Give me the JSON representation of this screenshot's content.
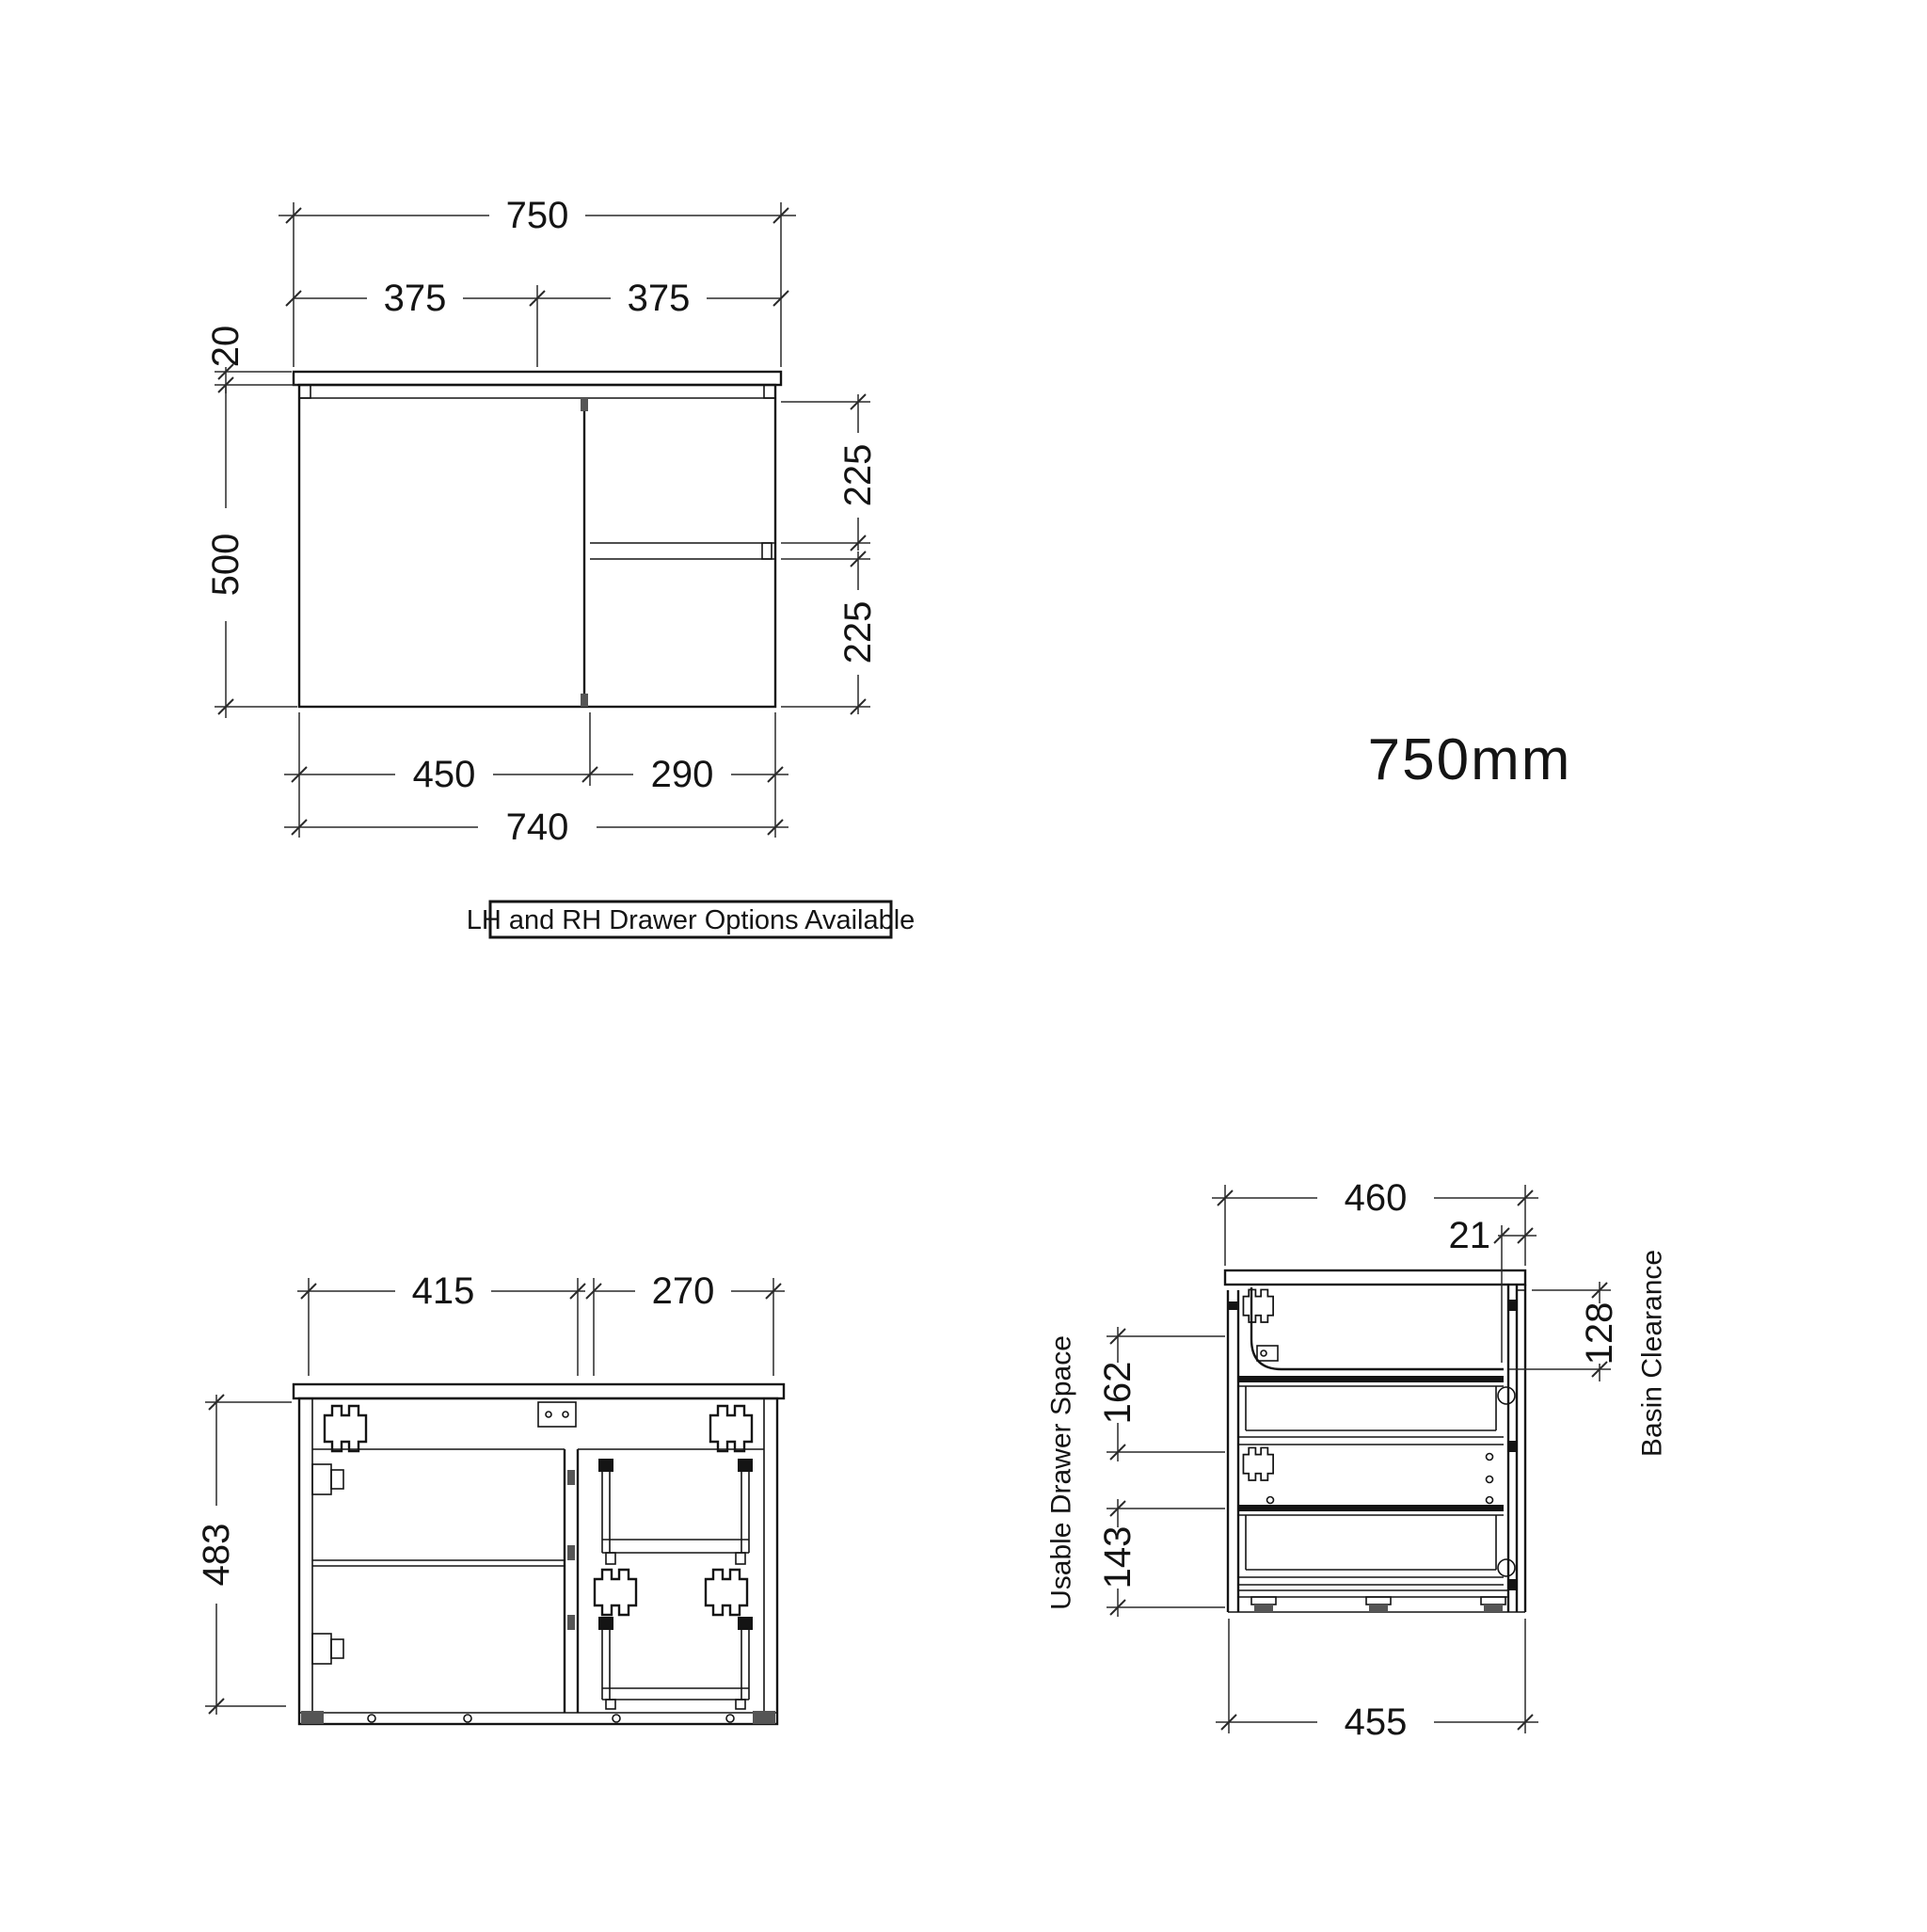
{
  "size_label": "750mm",
  "callout": {
    "text": "LH and RH Drawer Options Available"
  },
  "front_view": {
    "dims": {
      "total_width": "750",
      "half_left": "375",
      "half_right": "375",
      "top_thickness": "20",
      "body_height": "500",
      "drawer_upper_height": "225",
      "drawer_lower_height": "225",
      "door_width": "450",
      "drawer_width": "290",
      "body_width": "740"
    }
  },
  "internal_view": {
    "dims": {
      "left_opening_width": "415",
      "right_opening_width": "270",
      "internal_height": "483"
    }
  },
  "side_view": {
    "dims": {
      "top_depth": "460",
      "front_gap": "21",
      "basin_clearance": "128",
      "upper_drawer_space": "162",
      "lower_drawer_space": "143",
      "body_depth": "455"
    },
    "labels": {
      "usable_drawer_space": "Usable Drawer Space",
      "basin_clearance": "Basin Clearance"
    }
  },
  "colors": {
    "line": "#141414",
    "background": "#ffffff"
  }
}
